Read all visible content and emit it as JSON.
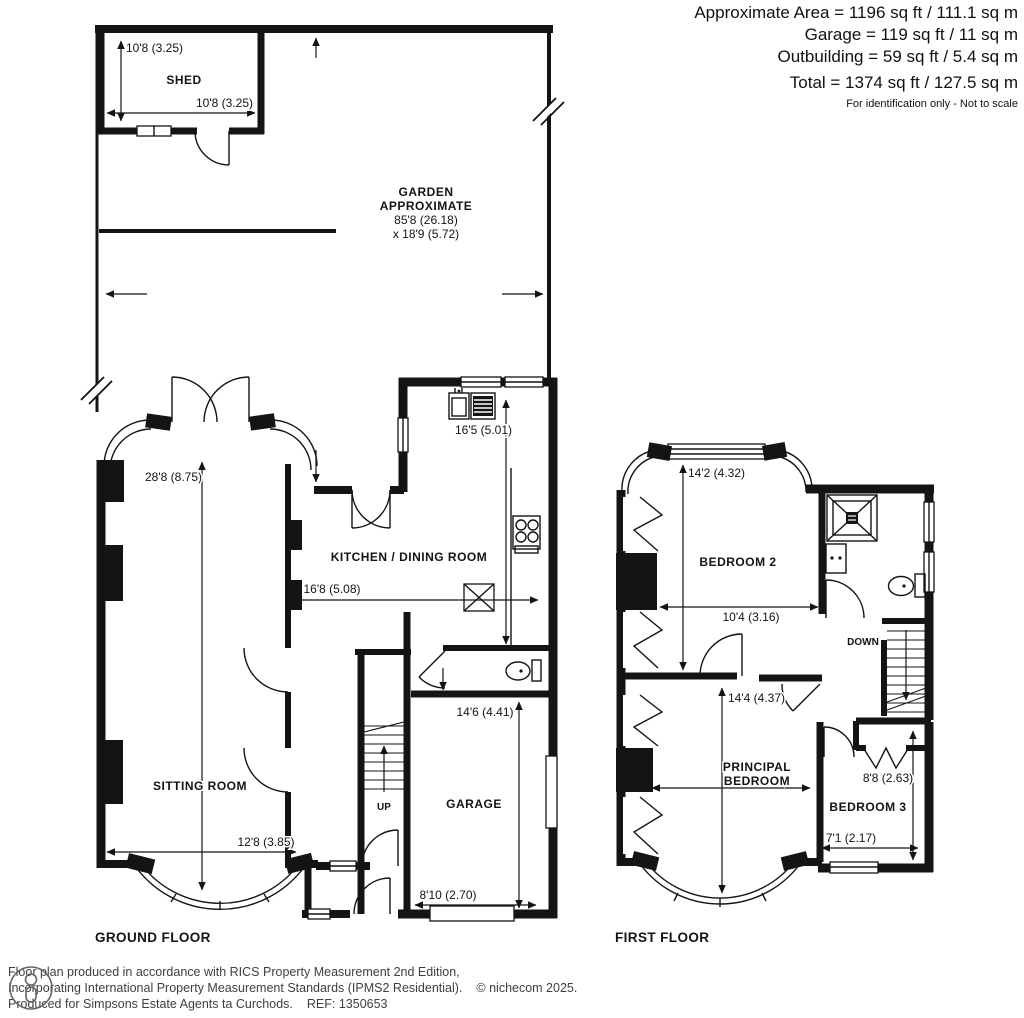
{
  "header": {
    "area": "Approximate Area = 1196 sq ft / 111.1 sq m",
    "garage": "Garage = 119 sq ft / 11 sq m",
    "outbuilding": "Outbuilding = 59 sq ft / 5.4 sq m",
    "total": "Total = 1374 sq ft / 127.5 sq m",
    "note": "For identification only - Not to scale"
  },
  "garden": {
    "title": "GARDEN",
    "subtitle": "APPROXIMATE",
    "length": "85'8 (26.18)",
    "width": "x 18'9 (5.72)"
  },
  "shed": {
    "label": "SHED",
    "dim_vertical": "10'8 (3.25)",
    "dim_horizontal": "10'8 (3.25)"
  },
  "ground": {
    "title": "GROUND FLOOR",
    "sitting": {
      "label": "SITTING ROOM",
      "dim_v": "28'8 (8.75)",
      "dim_h": "12'8 (3.85)"
    },
    "kitchen": {
      "label": "KITCHEN / DINING ROOM",
      "dim_v": "16'5 (5.01)",
      "dim_h": "16'8 (5.08)"
    },
    "garage": {
      "label": "GARAGE",
      "dim_v": "14'6 (4.41)",
      "dim_h": "8'10 (2.70)"
    },
    "stairs": "UP"
  },
  "first": {
    "title": "FIRST FLOOR",
    "bed2": {
      "label": "BEDROOM 2",
      "dim_v": "14'2 (4.32)",
      "dim_h": "10'4 (3.16)"
    },
    "principal": {
      "line1": "PRINCIPAL",
      "line2": "BEDROOM",
      "dim_v": "14'4 (4.37)"
    },
    "bed3": {
      "label": "BEDROOM 3",
      "dim_v": "8'8 (2.63)",
      "dim_h": "7'1 (2.17)"
    },
    "stairs": "DOWN"
  },
  "footer": {
    "line1": "Floor plan produced in accordance with RICS Property Measurement 2nd Edition,",
    "line2": "Incorporating International Property Measurement Standards (IPMS2 Residential).",
    "copyright": "© nichecom 2025.",
    "line3": "Produced for Simpsons Estate Agents ta Curchods.",
    "ref": "REF: 1350653"
  },
  "colors": {
    "ink": "#141414",
    "background": "#ffffff"
  }
}
